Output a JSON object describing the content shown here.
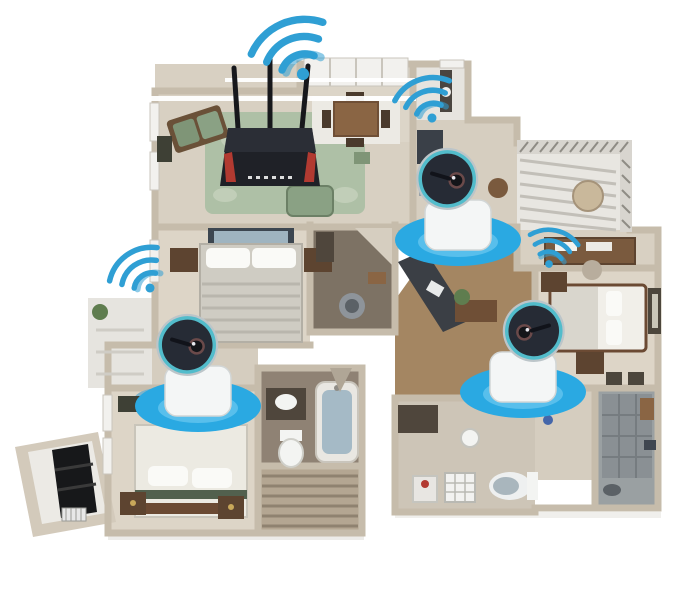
{
  "scene": {
    "title": "smart-home-floorplan",
    "description": "3D apartment floor plan illustrating WiFi coverage: one router with antennas in the living room and three wireless security cameras on blue coverage discs",
    "background": "#ffffff"
  },
  "colors": {
    "coverage_disc": "#2aa9e2",
    "coverage_disc_glow": "#7ed2f4",
    "wifi_signal": "#2f9fd4",
    "camera_ring": "#52bccb",
    "camera_face": "#262b35",
    "camera_base": "#f4f6f6",
    "router_body": "#1f2127",
    "router_accent": "#b23a31",
    "wall": "#c6bcab",
    "carpet": "#dcd4c6",
    "wood_floor": "#a48662",
    "rug_green": "#aec0a6"
  },
  "devices": {
    "router": {
      "name": "wifi-router",
      "x": 270,
      "y": 158,
      "antennas": 3
    },
    "router_wifi": {
      "x": 303,
      "y": 74,
      "rotate": -24,
      "scale": 1.35
    },
    "cameras": [
      {
        "name": "camera-kitchen",
        "x": 458,
        "y": 240,
        "head_flip": false,
        "wifi": {
          "dx": -26,
          "dy": -122,
          "rotate": -20,
          "scale": 1.0
        }
      },
      {
        "name": "camera-bedroom-left",
        "x": 198,
        "y": 406,
        "head_flip": false,
        "wifi": {
          "dx": -48,
          "dy": -118,
          "rotate": -35,
          "scale": 1.0
        }
      },
      {
        "name": "camera-bedroom-right",
        "x": 523,
        "y": 392,
        "head_flip": true,
        "wifi": {
          "dx": 26,
          "dy": -128,
          "rotate": 12,
          "scale": 0.85
        }
      }
    ]
  },
  "rooms": [
    {
      "name": "living-room"
    },
    {
      "name": "dining-nook"
    },
    {
      "name": "utility-room"
    },
    {
      "name": "kitchen-hall"
    },
    {
      "name": "balcony"
    },
    {
      "name": "office-area"
    },
    {
      "name": "bedroom-right"
    },
    {
      "name": "master-bedroom"
    },
    {
      "name": "bathroom-middle"
    },
    {
      "name": "bedroom-left"
    },
    {
      "name": "bathroom-left"
    },
    {
      "name": "stairs"
    },
    {
      "name": "bathroom-bottom"
    },
    {
      "name": "closet-shower"
    },
    {
      "name": "entry-alcove"
    }
  ]
}
